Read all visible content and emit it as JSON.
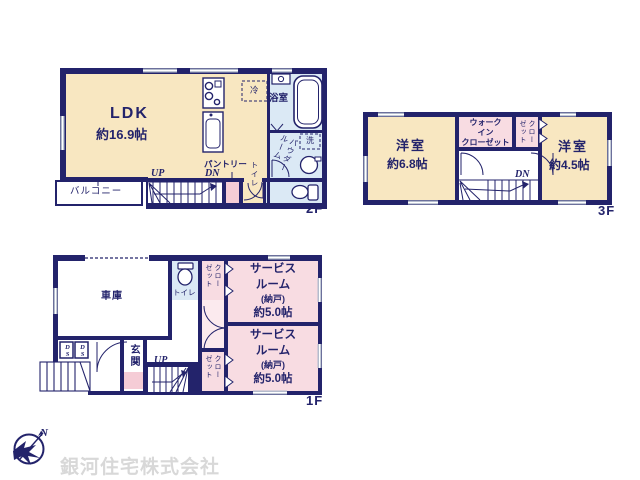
{
  "colors": {
    "wall": "#23236b",
    "room_cream": "#f8e7c1",
    "room_pink": "#f8dce2",
    "room_pink_deep": "#f5ccd6",
    "room_blue": "#dbe9f5",
    "hall_pink": "#fbeaee",
    "text_navy": "#23236b",
    "window_gray": "#b4bccd",
    "watermark_gray": "#d8d8d8"
  },
  "floor2": {
    "label": "2F",
    "ldk_name": "LDK",
    "ldk_size": "約16.9帖",
    "balcony": "バルコニー",
    "bath": "浴室",
    "powder_room": "パウダールーム",
    "washer": "洗",
    "fridge": "冷",
    "pantry": "パントリー",
    "toilet": "トイレ",
    "up": "UP",
    "down": "DN"
  },
  "floor3": {
    "label": "3F",
    "room_left_name": "洋室",
    "room_left_size": "約6.8帖",
    "room_right_name": "洋室",
    "room_right_size": "約4.5帖",
    "wic_lines": [
      "ウォーク",
      "イン",
      "クローゼット"
    ],
    "closet": "クローゼット",
    "down": "DN"
  },
  "floor1": {
    "label": "1F",
    "garage": "車庫",
    "toilet": "トイレ",
    "closet": "クローゼット",
    "service_room_lines": [
      "サービス",
      "ルーム",
      "(納戸)",
      "約5.0帖"
    ],
    "entrance": "玄関",
    "duct": "DS",
    "up": "UP"
  },
  "compass": {
    "north": "N"
  },
  "company": "銀河住宅株式会社"
}
